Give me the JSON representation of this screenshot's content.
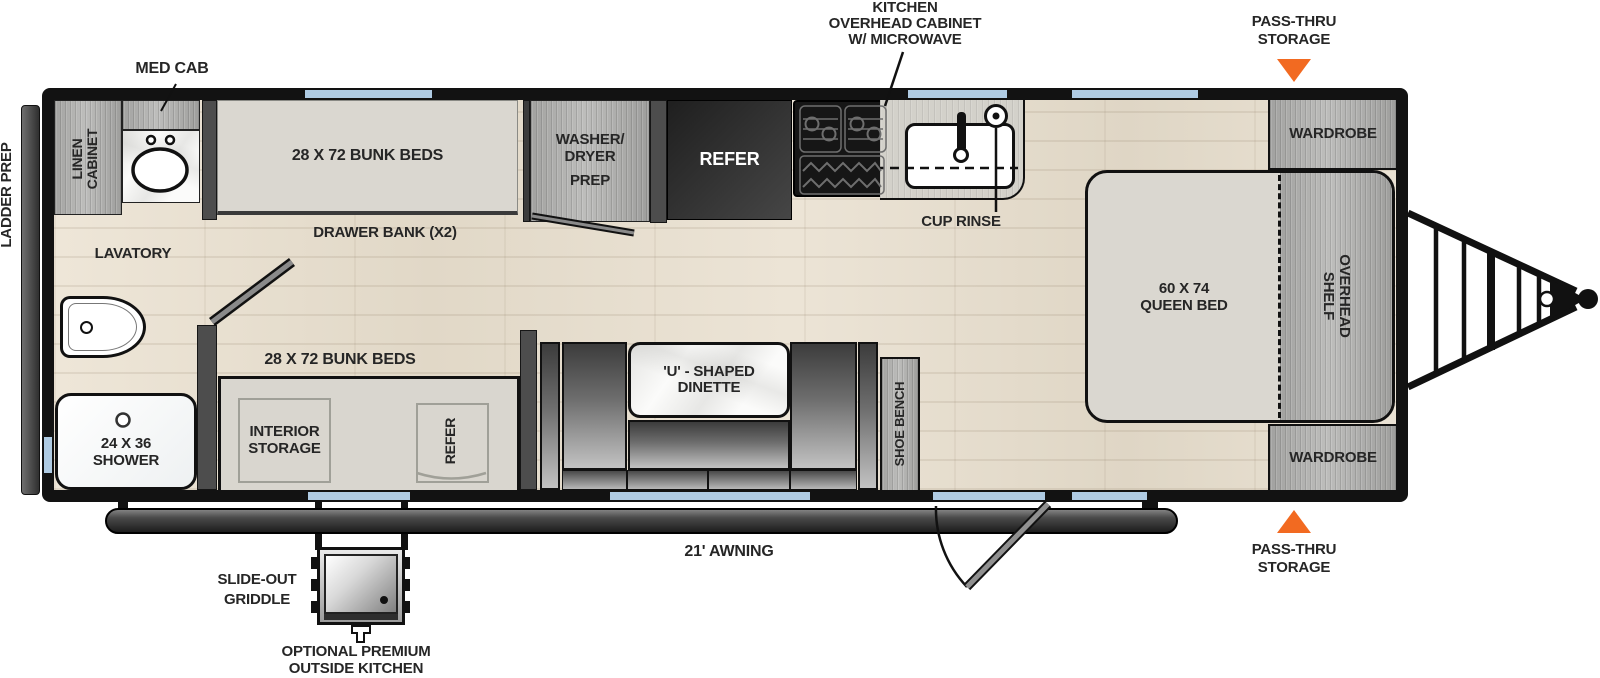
{
  "colors": {
    "accent_orange": "#F26A21",
    "window_blue": "#AFCBE3",
    "wall_black": "#121212",
    "floor_wood": "#E8E0D2",
    "cabinet_gray": "#B4B4B2",
    "bed_fill": "#DAD7D0"
  },
  "labels": {
    "ladder_prep": "LADDER PREP",
    "med_cab": "MED CAB",
    "linen_cabinet": {
      "l1": "LINEN",
      "l2": "CABINET"
    },
    "lavatory": "LAVATORY",
    "shower": {
      "l1": "24 X 36",
      "l2": "SHOWER"
    },
    "bunk_top": "28 X 72 BUNK BEDS",
    "drawer_bank": "DRAWER BANK (X2)",
    "washer_dryer": {
      "l1": "WASHER/",
      "l2": "DRYER",
      "l3": "PREP"
    },
    "refer_top": "REFER",
    "kitchen_overhead": {
      "l1": "KITCHEN",
      "l2": "OVERHEAD CABINET",
      "l3": "W/ MICROWAVE"
    },
    "cup_rinse": "CUP RINSE",
    "pass_thru_top": {
      "l1": "PASS-THRU",
      "l2": "STORAGE"
    },
    "wardrobe_top": "WARDROBE",
    "queen_bed": {
      "l1": "60 X 74",
      "l2": "QUEEN BED"
    },
    "overhead_shelf": {
      "l1": "OVERHEAD",
      "l2": "SHELF"
    },
    "wardrobe_bottom": "WARDROBE",
    "pass_thru_bottom": {
      "l1": "PASS-THRU",
      "l2": "STORAGE"
    },
    "bunk_bottom": "28 X 72 BUNK BEDS",
    "interior_storage": {
      "l1": "INTERIOR",
      "l2": "STORAGE"
    },
    "refer_bottom": "REFER",
    "dinette": {
      "l1": "'U' - SHAPED",
      "l2": "DINETTE"
    },
    "shoe_bench": "SHOE BENCH",
    "awning": "21' AWNING",
    "slide_out_griddle": {
      "l1": "SLIDE-OUT",
      "l2": "GRIDDLE"
    },
    "outside_kitchen": {
      "l1": "OPTIONAL PREMIUM",
      "l2": "OUTSIDE KITCHEN"
    }
  }
}
